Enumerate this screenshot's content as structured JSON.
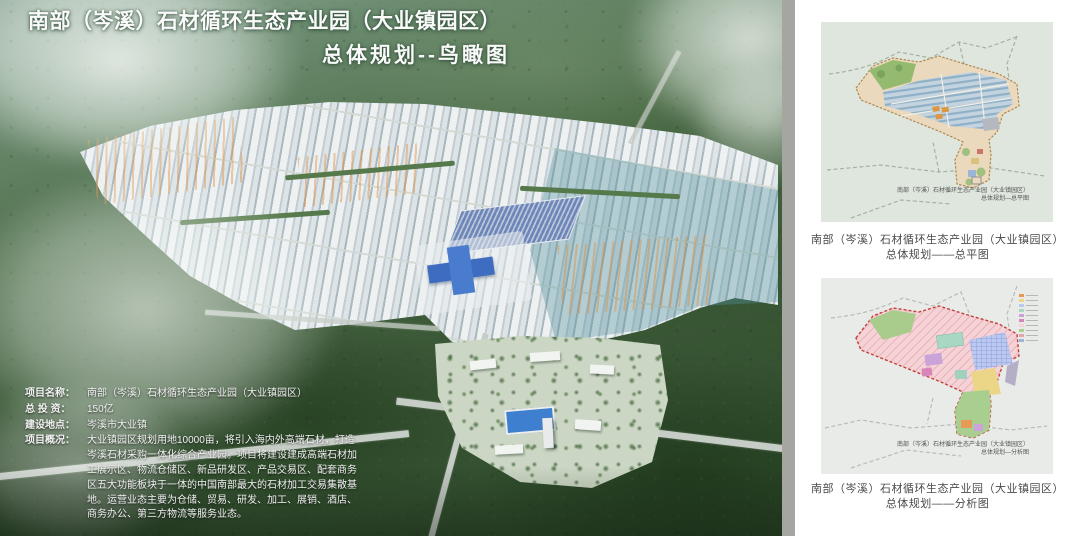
{
  "render": {
    "title_line1": "南部（岑溪）石材循环生态产业园（大业镇园区）",
    "title_line2": "总体规划--鸟瞰图",
    "info_fields": [
      {
        "label": "项目名称：",
        "value": "南部（岑溪）石材循环生态产业园（大业镇园区）"
      },
      {
        "label": "总 投 资：",
        "value": "150亿"
      },
      {
        "label": "建设地点：",
        "value": "岑溪市大业镇"
      },
      {
        "label": "项目概况：",
        "value": "大业镇园区规划用地10000亩，将引入海内外高端石材，打造岑溪石材采购一体化综合产业园。项目将建设建成高端石材加工展示区、物流仓储区、新品研发区、产品交易区、配套商务区五大功能板块于一体的中国南部最大的石材加工交易集散基地。运营业态主要为仓储、贸易、研发、加工、展销、酒店、商务办公、第三方物流等服务业态。"
      }
    ]
  },
  "panel": {
    "maps": [
      {
        "inmap_line1": "南部（岑溪）石材循环生态产业园（大业镇园区）",
        "inmap_line2": "总体规划—总平图",
        "caption_line1": "南部（岑溪）石材循环生态产业园（大业镇园区）",
        "caption_line2": "总体规划——总平图"
      },
      {
        "inmap_line1": "南部（岑溪）石材循环生态产业园（大业镇园区）",
        "inmap_line2": "总体规划—分析图",
        "caption_line1": "南部（岑溪）石材循环生态产业园（大业镇园区）",
        "caption_line2": "总体规划——分析图"
      }
    ]
  },
  "colors": {
    "accent_blue": "#3d6cc0",
    "forest_dark": "#2e4b2a",
    "plan_tan": "#ead9bd",
    "analysis_pink": "#f5d2d6",
    "boundary_red": "#c2413b",
    "divider_gray": "#a5a6a2"
  }
}
